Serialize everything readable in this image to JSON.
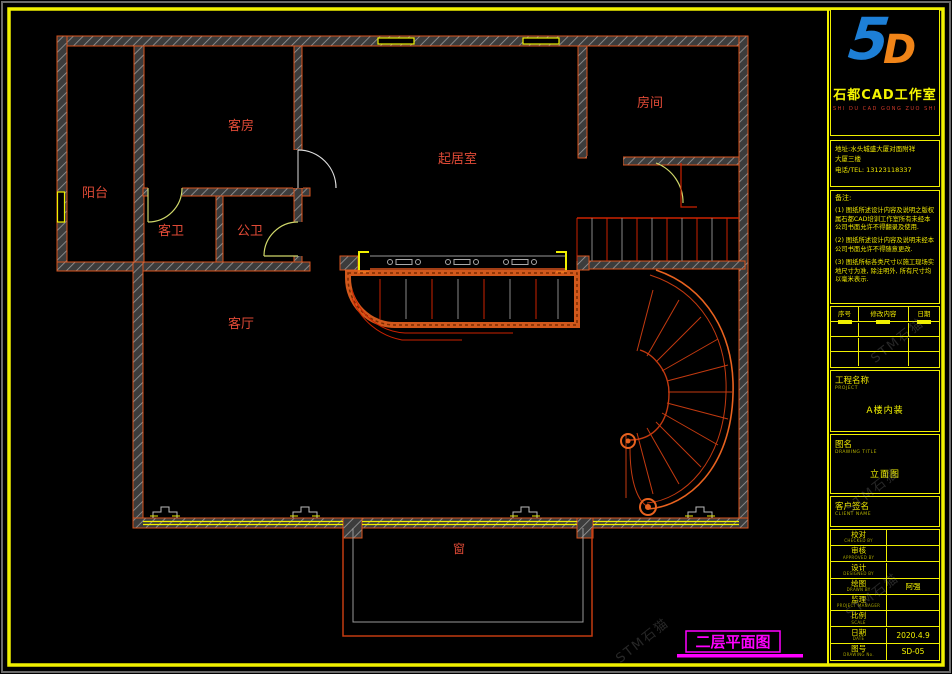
{
  "sheet": {
    "bg": "#000000",
    "frame_color": "#f0f000",
    "edge_color": "#6a6a6a"
  },
  "plan": {
    "label_color": "#e04a36",
    "caption": "二层平面图",
    "caption_color": "#ff00ff",
    "rooms": [
      {
        "id": "balcony",
        "label": "阳台"
      },
      {
        "id": "guest-room",
        "label": "客房"
      },
      {
        "id": "living-room",
        "label": "起居室"
      },
      {
        "id": "room",
        "label": "房间"
      },
      {
        "id": "guest-bath",
        "label": "客卫"
      },
      {
        "id": "public-bath",
        "label": "公卫"
      },
      {
        "id": "hall",
        "label": "客厅"
      },
      {
        "id": "window-label",
        "label": "窗"
      }
    ]
  },
  "watermark": {
    "text": "STM石猫"
  },
  "title_block": {
    "logo": {
      "glyph_blue": "5",
      "glyph_orange": "D",
      "name": "石都CAD工作室",
      "pinyin": "SHI DU CAD GONG ZUO SHI"
    },
    "address": {
      "line1": "地址:水头城盛大厦对面附祥",
      "line2": "大厦三楼",
      "line3": "电话/TEL: 13123118337"
    },
    "notes": {
      "title": "备注:",
      "items": [
        "(1) 图纸所述设计内容及说明之版权属石都CAD培训工作室所有未经本公司书面允许不得翻录及使用.",
        "(2) 图纸所述设计内容及说明未经本公司书面允许不得随意更改.",
        "(3) 图纸所标各类尺寸以施工现场实地尺寸为准, 除注明外, 所有尺寸均以毫米表示."
      ]
    },
    "revision_table": {
      "headers": [
        "序号",
        "修改内容",
        "日期"
      ]
    },
    "project": {
      "label": "工程名称",
      "label_en": "PROJECT",
      "value": "A楼内装"
    },
    "drawing": {
      "label": "图名",
      "label_en": "DRAWING TITLE",
      "value": "立面图"
    },
    "client": {
      "label": "客户签名",
      "label_en": "CLIENT NAME"
    },
    "info_rows": [
      {
        "label": "校对",
        "en": "CHECKED BY",
        "value": ""
      },
      {
        "label": "审核",
        "en": "APPROVED BY",
        "value": ""
      },
      {
        "label": "设计",
        "en": "DESIGNED BY",
        "value": ""
      },
      {
        "label": "绘图",
        "en": "DRAWN BY",
        "value": "阿强"
      },
      {
        "label": "监理",
        "en": "PROJECT MANAGER",
        "value": ""
      },
      {
        "label": "比例",
        "en": "SCALE",
        "value": ""
      },
      {
        "label": "日期",
        "en": "DATE",
        "value": "2020.4.9"
      },
      {
        "label": "图号",
        "en": "DRAWING No.",
        "value": "SD-05"
      }
    ]
  }
}
